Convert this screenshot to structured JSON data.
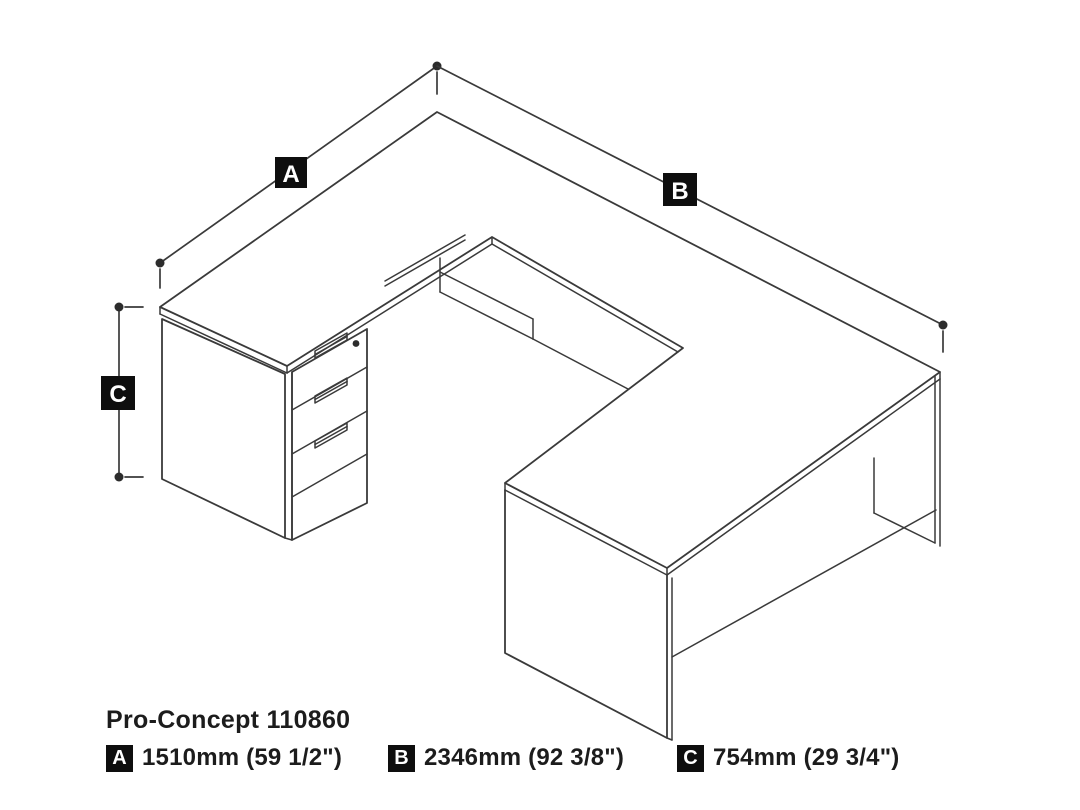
{
  "title": "Pro-Concept 110860",
  "diagram": {
    "label_a": "A",
    "label_b": "B",
    "label_c": "C",
    "description": "isometric line drawing of U-shaped desk with three-drawer pedestal"
  },
  "legend": {
    "items": [
      {
        "key": "A",
        "value": "1510mm (59 1/2\")"
      },
      {
        "key": "B",
        "value": "2346mm (92 3/8\")"
      },
      {
        "key": "C",
        "value": "754mm (29 3/4\")"
      }
    ]
  },
  "colors": {
    "line": "#3a3a3a",
    "label_bg": "#0e0e0e",
    "label_text": "#ffffff",
    "text": "#1c1c1c",
    "background": "#ffffff"
  }
}
